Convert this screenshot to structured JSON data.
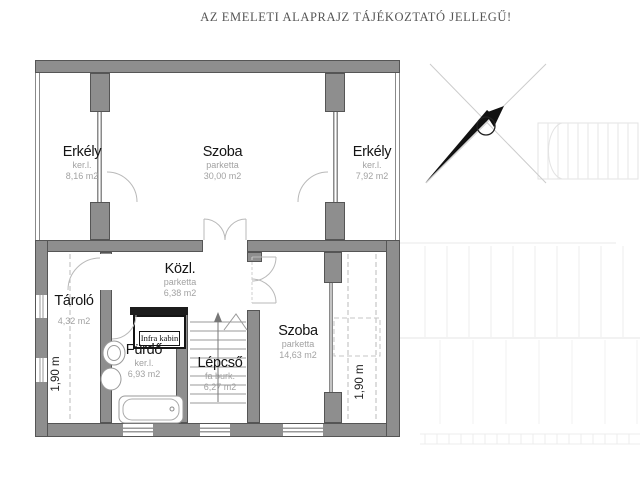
{
  "title": "AZ EMELETI ALAPRAJZ TÁJÉKOZTATÓ JELLEGŰ!",
  "rooms": {
    "erkely_left": {
      "name": "Erkély",
      "finish": "ker.l.",
      "area": "8,16 m2"
    },
    "szoba_top": {
      "name": "Szoba",
      "finish": "parketta",
      "area": "30,00 m2"
    },
    "erkely_right": {
      "name": "Erkély",
      "finish": "ker.l.",
      "area": "7,92 m2"
    },
    "kozl": {
      "name": "Közl.",
      "finish": "parketta",
      "area": "6,38 m2"
    },
    "tarolo": {
      "name": "Tároló",
      "area": "4,32 m2"
    },
    "furdo": {
      "name": "Fürdő",
      "finish": "ker.l.",
      "area": "6,93 m2"
    },
    "lepcso": {
      "name": "Lépcső",
      "finish": "fa burk.",
      "area": "6,27 m2"
    },
    "szoba_lower": {
      "name": "Szoba",
      "finish": "parketta",
      "area": "14,63 m2"
    },
    "infra_kabin": {
      "name": "Infra kabin"
    }
  },
  "dimension_labels": {
    "left": "1,90 m",
    "right": "1,90 m"
  },
  "colors": {
    "wall_fill": "#8e8e8e",
    "wall_edge": "#555555",
    "room_label": "#141414",
    "finish_label": "#a2a2a2",
    "title_text": "#555555",
    "door_arc": "#b9b9b9",
    "north_arrow": "#111111"
  }
}
